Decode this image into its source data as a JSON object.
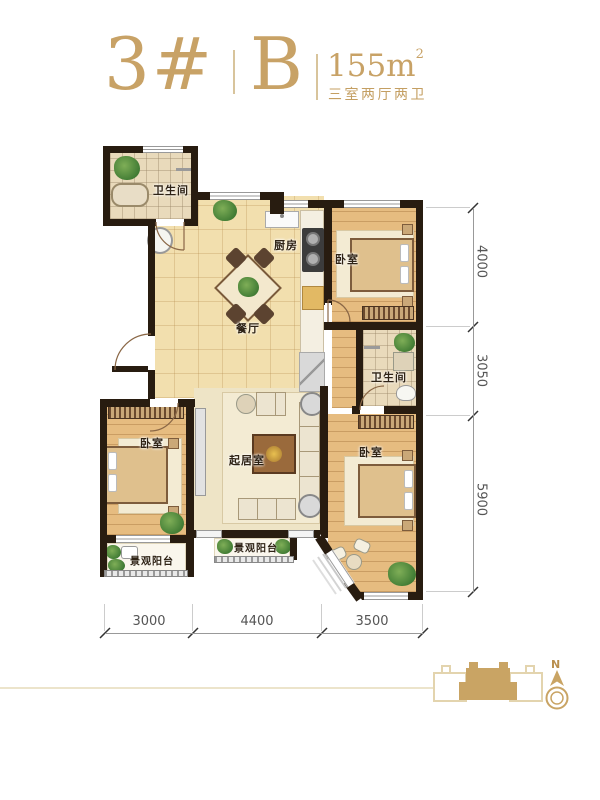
{
  "header": {
    "block_number": "3#",
    "unit": "B",
    "area_value": "155m",
    "area_superscript": "2",
    "layout_description": "三室两厅两卫"
  },
  "rooms": [
    {
      "label": "卫生间"
    },
    {
      "label": "厨房"
    },
    {
      "label": "卧室"
    },
    {
      "label": "餐厅"
    },
    {
      "label": "卫生间"
    },
    {
      "label": "卧室"
    },
    {
      "label": "起居室"
    },
    {
      "label": "卧室"
    },
    {
      "label": "景观阳台"
    },
    {
      "label": "景观阳台"
    }
  ],
  "dimensions": {
    "right": [
      "4000",
      "3050",
      "5900"
    ],
    "bottom": [
      "3000",
      "4400",
      "3500"
    ]
  },
  "compass": {
    "label": "N"
  },
  "colors": {
    "accent_gold": "#c8a266",
    "wall": "#281c10",
    "highlight_unit": "#c9a464"
  }
}
